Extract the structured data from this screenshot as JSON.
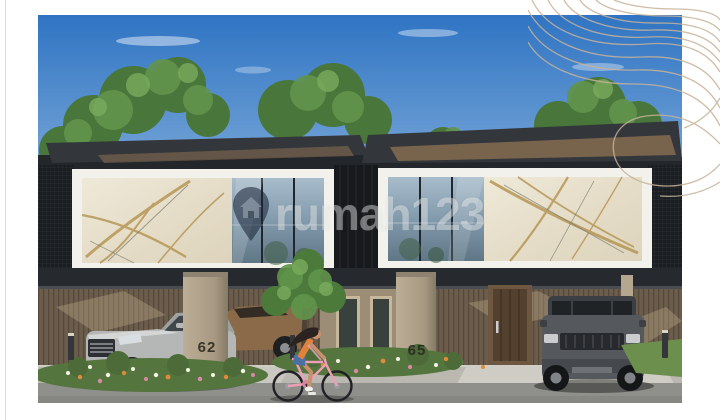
{
  "page": {
    "background": "#ffffff",
    "left_rule_color": "#dcdcda"
  },
  "decoration": {
    "name": "contour-swirl-ornament",
    "color": "#c7b29a"
  },
  "photo": {
    "alt": "3D render of modern two-storey townhouses with marble and glass facades, carports with parked cars, flower beds, and a woman riding a pink bicycle past the houses",
    "watermark": {
      "text": "rumah123",
      "icon": "map-pin-house-icon"
    },
    "left_house_number": "62",
    "right_house_number": "65",
    "colors": {
      "sky_top": "#2f74c3",
      "sky_bottom": "#93b9e0",
      "roof": "#33373b",
      "soffit_wood": "#8a6f52",
      "fascia_white": "#f2f1ec",
      "marble": "#e9e3d1",
      "marble_vein_gold": "#b3924f",
      "glass": "#8ba3b5",
      "mesh_panel": "#1b1e21",
      "wood_slats": "#6b5c4b",
      "pillar": "#b5a78f",
      "door_wood": "#53402f",
      "driveway": "#c9c7bf",
      "road": "#8f8f8c",
      "foliage": "#5d8a4a",
      "flower_orange": "#e08a3c",
      "flower_pink": "#d98aa6",
      "flower_white": "#f5f2e6",
      "sedan": "#b4b7b6",
      "bronze_car": "#8a6a48",
      "suv": "#55585c",
      "bicycle": "#ef9fb5",
      "rider_top": "#e0813c",
      "rider_shorts": "#4a6fa5"
    }
  }
}
